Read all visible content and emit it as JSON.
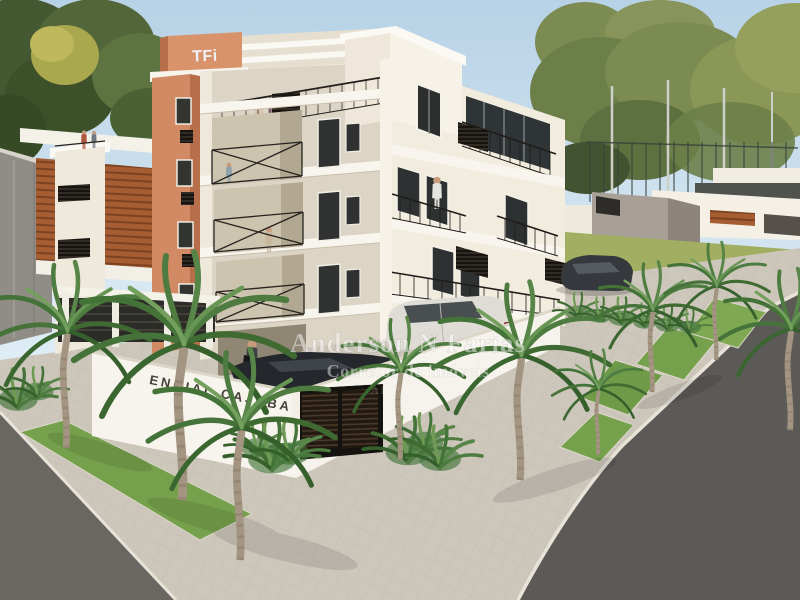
{
  "scene": {
    "description": "3D architectural exterior rendering of a corner-lot residential apartment building with palm-lined sidewalks, parked cars and neighboring houses",
    "building": {
      "tower_logo": "TFi",
      "entrance_sign": "ENCIAL CAJUBA"
    },
    "watermark": {
      "line1": "Anderson N Farias",
      "line2": "Corretor de imóveis",
      "line3": "API Challe 6"
    },
    "palette": {
      "sky": "#bfd9ea",
      "facade_light": "#f2ecdf",
      "facade_shadow": "#dcd4c5",
      "tower_orange": "#d28a64",
      "railing_black": "#22201e",
      "palm_green": "#4e7c40",
      "lawn_green": "#76a14c",
      "sidewalk": "#ccc6bb",
      "street": "#615e5a",
      "suv_color": "#dfdcd5",
      "sedan_color": "#24272b",
      "watermark_white": "#ffffff"
    }
  }
}
